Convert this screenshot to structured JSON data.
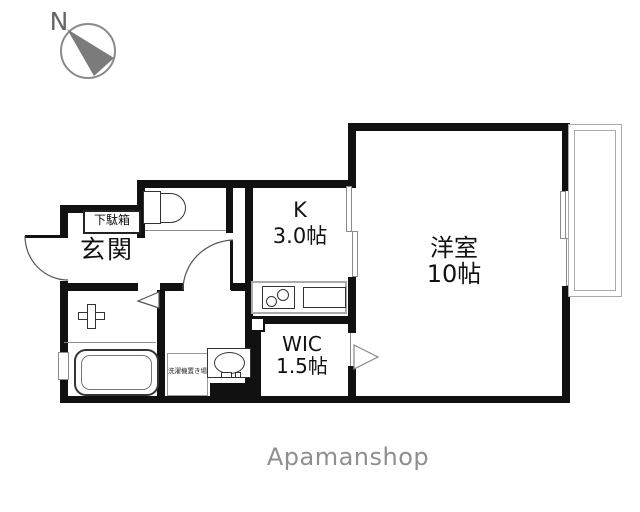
{
  "compass": {
    "label": "N"
  },
  "floor_plan": {
    "rooms": {
      "entrance": {
        "label": "玄関"
      },
      "shoe_cabinet": {
        "label": "下駄箱"
      },
      "kitchen": {
        "label": "K",
        "area": "3.0帖"
      },
      "western_room": {
        "label": "洋室",
        "area": "10帖"
      },
      "walk_in_closet": {
        "label": "WIC",
        "area": "1.5帖"
      },
      "laundry_space": {
        "label": "洗濯機置き場"
      }
    },
    "fixtures": [
      "toilet",
      "bathtub",
      "bath-faucet",
      "stove",
      "kitchen-sink",
      "vanity-basin",
      "washing-machine-space",
      "shoe-cabinet",
      "balcony",
      "sliding-window",
      "entrance-door",
      "hall-door",
      "folding-door",
      "closet-door"
    ]
  },
  "footer": {
    "brand": "Apamanshop"
  },
  "colors": {
    "wall": "#111111",
    "fixture_line": "#333333",
    "brand_text": "#8f8f8f",
    "compass": "#7b7b7b"
  }
}
